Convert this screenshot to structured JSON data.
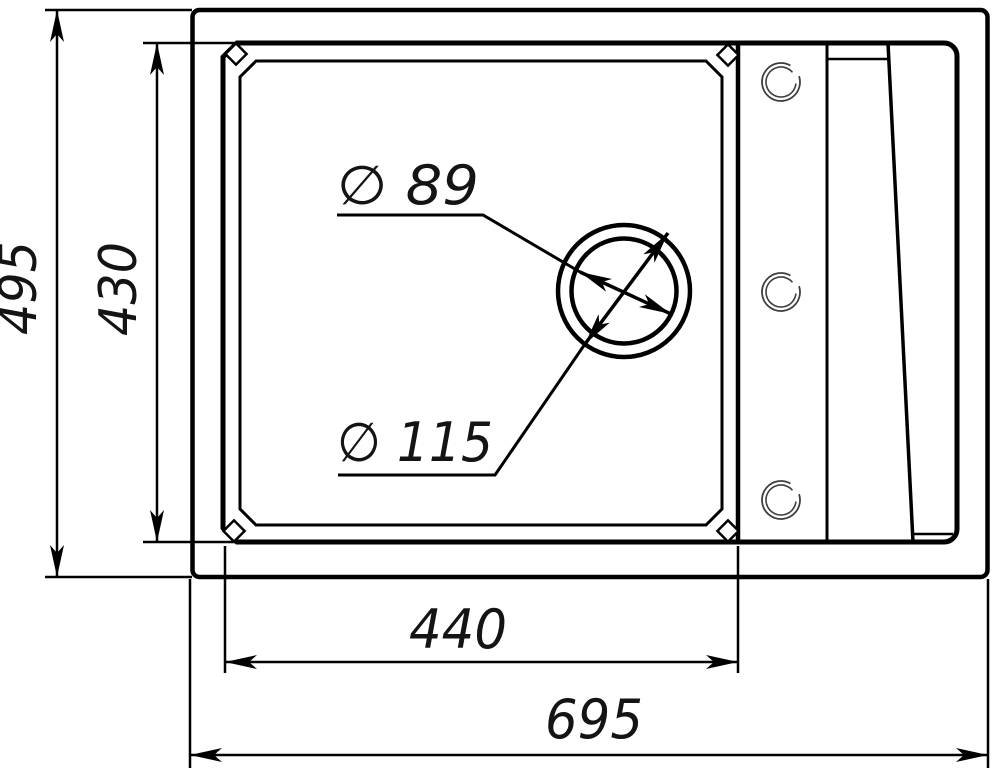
{
  "drawing": {
    "title": "Sink top-view dimensional drawing",
    "background_color": "#ffffff",
    "line_color": "#000000",
    "dimension_labels": {
      "overall_width": "695",
      "overall_depth": "495",
      "bowl_width": "440",
      "bowl_depth": "430",
      "drain_outer_diameter": "∅ 115",
      "drain_inner_diameter": "∅ 89"
    },
    "dimension_values": {
      "overall_width": 695,
      "overall_depth": 495,
      "bowl_width": 440,
      "bowl_depth": 430,
      "drain_outer_diameter": 115,
      "drain_inner_diameter": 89
    },
    "tap_hole_count": 3
  }
}
